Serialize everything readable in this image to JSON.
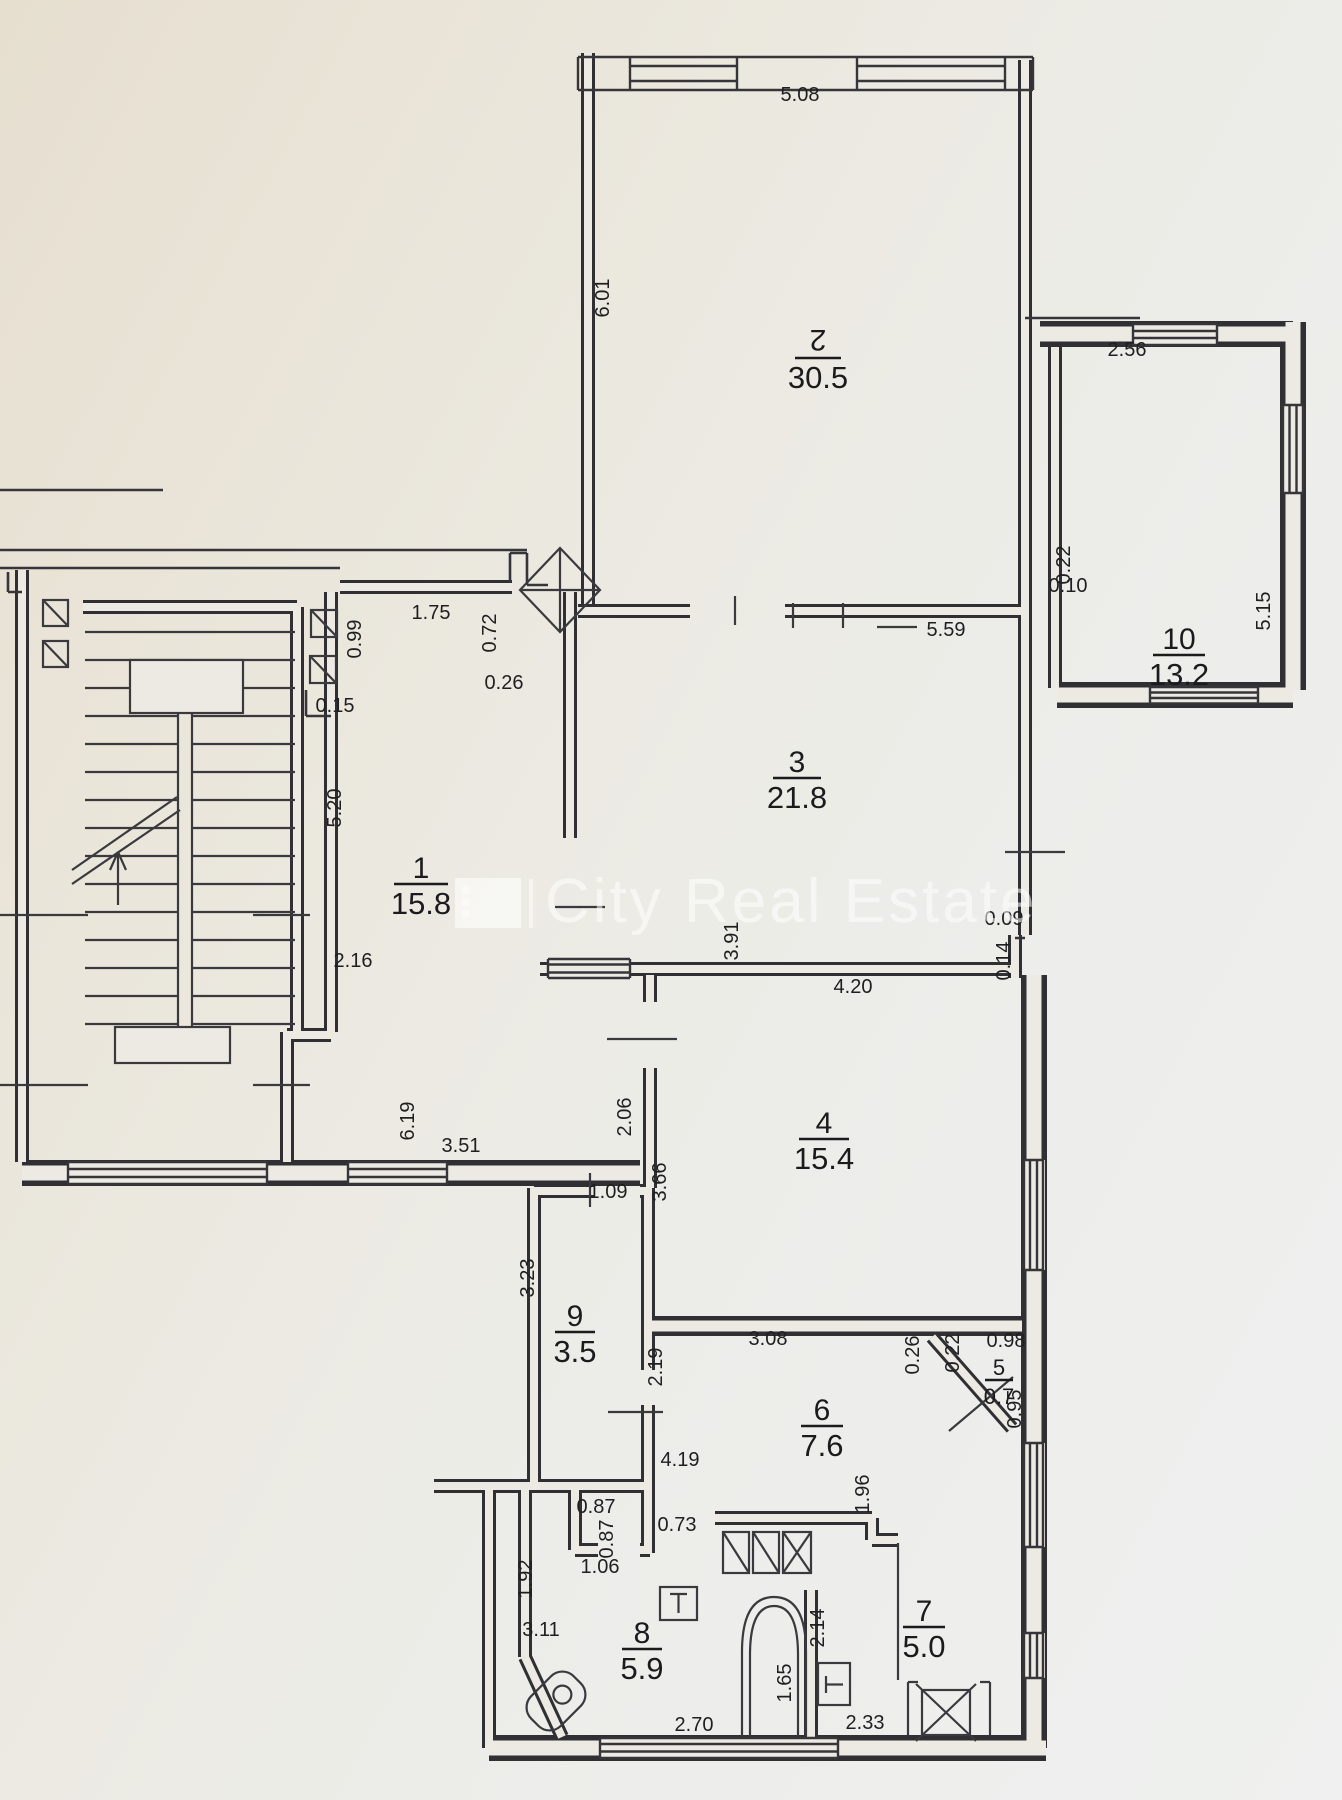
{
  "watermark": {
    "brand": "City Real Estate"
  },
  "plan": {
    "rooms": [
      {
        "number": "2",
        "area": "30.5",
        "x": 818,
        "y": 358,
        "flip": true,
        "w": 46
      },
      {
        "number": "10",
        "area": "13.2",
        "x": 1179,
        "y": 655,
        "w": 52
      },
      {
        "number": "3",
        "area": "21.8",
        "x": 797,
        "y": 778,
        "w": 48
      },
      {
        "number": "1",
        "area": "15.8",
        "x": 421,
        "y": 884,
        "w": 54
      },
      {
        "number": "4",
        "area": "15.4",
        "x": 824,
        "y": 1139,
        "w": 50
      },
      {
        "number": "9",
        "area": "3.5",
        "x": 575,
        "y": 1332,
        "w": 40
      },
      {
        "number": "6",
        "area": "7.6",
        "x": 822,
        "y": 1426,
        "w": 42
      },
      {
        "number": "5",
        "area": "0.7",
        "x": 999,
        "y": 1380,
        "small": true,
        "w": 28
      },
      {
        "number": "8",
        "area": "5.9",
        "x": 642,
        "y": 1649,
        "w": 40
      },
      {
        "number": "7",
        "area": "5.0",
        "x": 924,
        "y": 1627,
        "w": 42
      }
    ],
    "dimensions": [
      {
        "v": "5.08",
        "x": 800,
        "y": 101,
        "r": 0
      },
      {
        "v": "6.01",
        "x": 609,
        "y": 298,
        "r": -90
      },
      {
        "v": "2.56",
        "x": 1127,
        "y": 356,
        "r": 0
      },
      {
        "v": "0.22",
        "x": 1070,
        "y": 565,
        "r": -90
      },
      {
        "v": "0.10",
        "x": 1068,
        "y": 592,
        "r": 0
      },
      {
        "v": "5.15",
        "x": 1270,
        "y": 611,
        "r": -90
      },
      {
        "v": "5.59",
        "x": 946,
        "y": 636,
        "r": 0
      },
      {
        "v": "0.99",
        "x": 361,
        "y": 639,
        "r": -90
      },
      {
        "v": "1.75",
        "x": 431,
        "y": 619,
        "r": 0
      },
      {
        "v": "0.72",
        "x": 496,
        "y": 633,
        "r": -90
      },
      {
        "v": "0.26",
        "x": 504,
        "y": 689,
        "r": 0
      },
      {
        "v": "0.15",
        "x": 335,
        "y": 712,
        "r": 0
      },
      {
        "v": "5.20",
        "x": 341,
        "y": 808,
        "r": -90
      },
      {
        "v": "2.16",
        "x": 353,
        "y": 967,
        "r": 0
      },
      {
        "v": "3.91",
        "x": 738,
        "y": 941,
        "r": -90
      },
      {
        "v": "0.09",
        "x": 1004,
        "y": 925,
        "r": 0
      },
      {
        "v": "0.14",
        "x": 1010,
        "y": 961,
        "r": -90
      },
      {
        "v": "4.20",
        "x": 853,
        "y": 993,
        "r": 0
      },
      {
        "v": "2.06",
        "x": 631,
        "y": 1117,
        "r": -90
      },
      {
        "v": "6.19",
        "x": 414,
        "y": 1121,
        "r": -90
      },
      {
        "v": "3.51",
        "x": 461,
        "y": 1152,
        "r": 0
      },
      {
        "v": "1.09",
        "x": 608,
        "y": 1198,
        "r": 0
      },
      {
        "v": "3.66",
        "x": 666,
        "y": 1182,
        "r": -90
      },
      {
        "v": "3.23",
        "x": 534,
        "y": 1278,
        "r": -90
      },
      {
        "v": "2.19",
        "x": 662,
        "y": 1367,
        "r": -90
      },
      {
        "v": "3.08",
        "x": 768,
        "y": 1345,
        "r": 0
      },
      {
        "v": "0.26",
        "x": 919,
        "y": 1355,
        "r": -90
      },
      {
        "v": "0.22",
        "x": 959,
        "y": 1353,
        "r": -90
      },
      {
        "v": "0.98",
        "x": 1006,
        "y": 1347,
        "r": 0
      },
      {
        "v": "0.95",
        "x": 1021,
        "y": 1409,
        "r": -90
      },
      {
        "v": "1.96",
        "x": 869,
        "y": 1494,
        "r": -90
      },
      {
        "v": "4.19",
        "x": 680,
        "y": 1466,
        "r": 0
      },
      {
        "v": "0.73",
        "x": 677,
        "y": 1531,
        "r": 0
      },
      {
        "v": "0.87",
        "x": 596,
        "y": 1513,
        "r": 0
      },
      {
        "v": "0.87",
        "x": 613,
        "y": 1539,
        "r": -90
      },
      {
        "v": "1.06",
        "x": 600,
        "y": 1573,
        "r": 0
      },
      {
        "v": "1.92",
        "x": 532,
        "y": 1579,
        "r": -90
      },
      {
        "v": "3.11",
        "x": 541,
        "y": 1636,
        "r": 0
      },
      {
        "v": "2.70",
        "x": 694,
        "y": 1731,
        "r": 0
      },
      {
        "v": "1.65",
        "x": 791,
        "y": 1683,
        "r": -90
      },
      {
        "v": "2.14",
        "x": 824,
        "y": 1628,
        "r": -90
      },
      {
        "v": "2.33",
        "x": 865,
        "y": 1729,
        "r": 0
      }
    ]
  }
}
